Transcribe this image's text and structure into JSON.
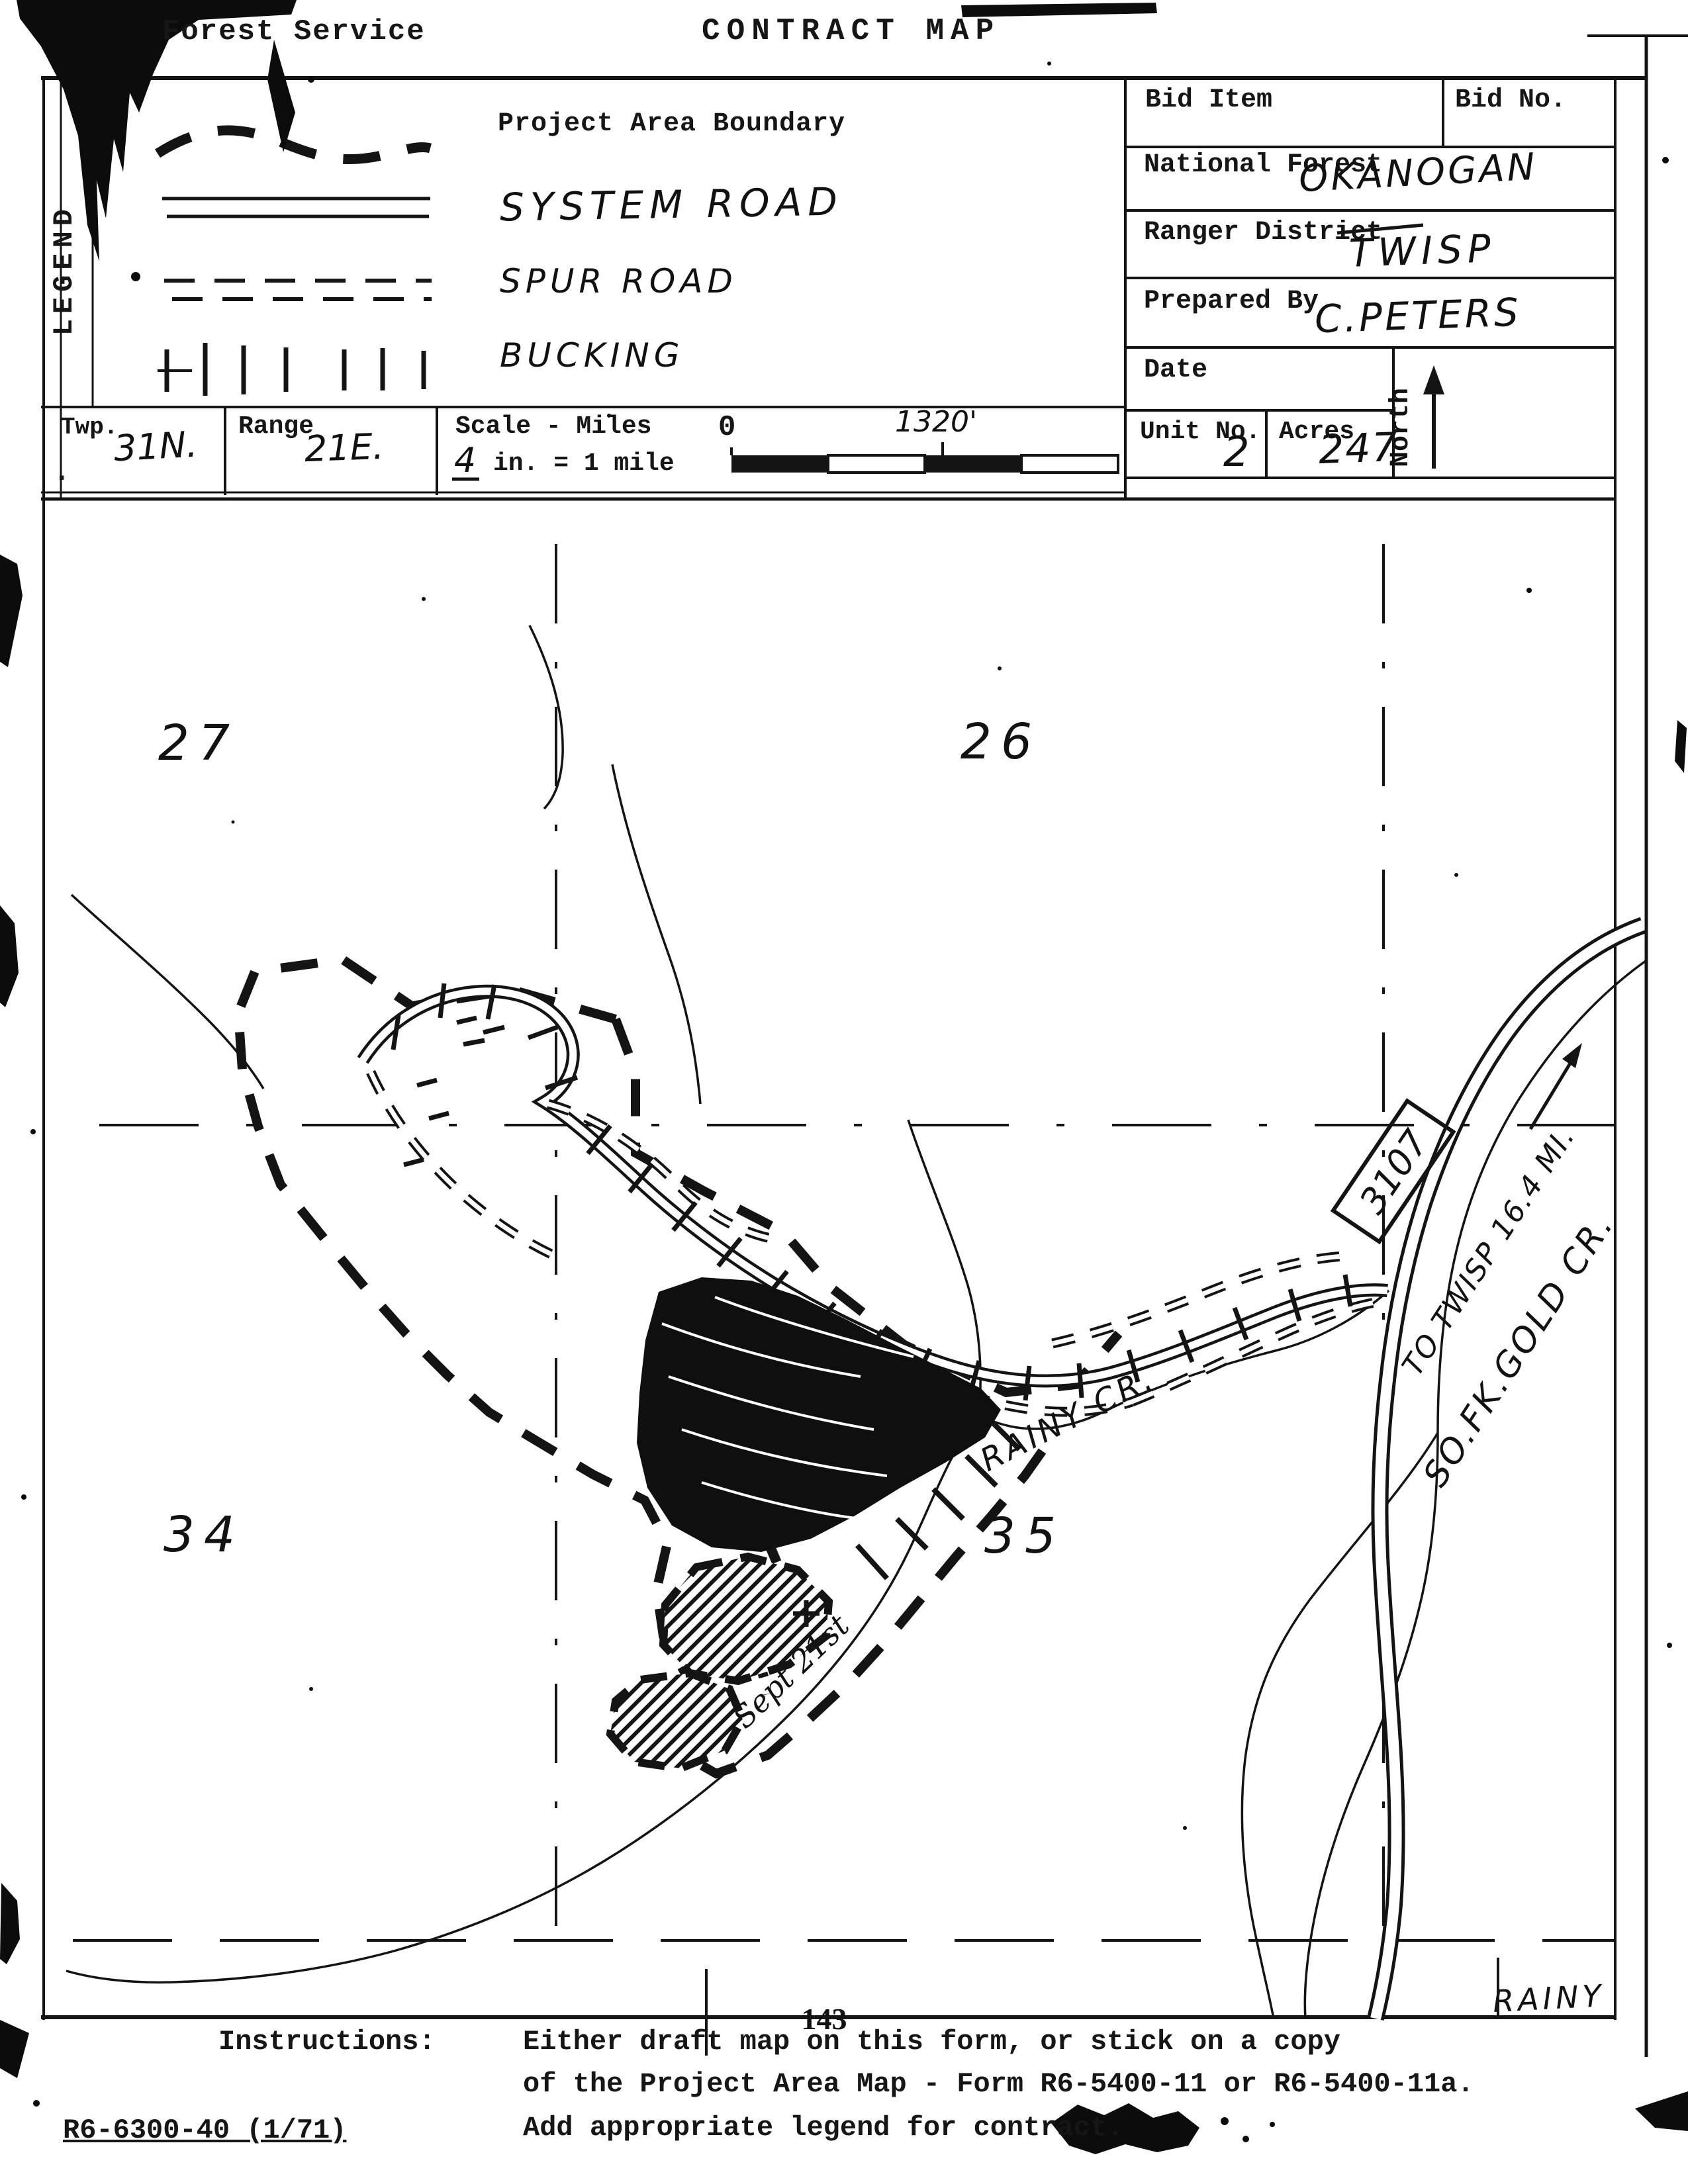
{
  "header": {
    "agency": "Forest Service",
    "title": "CONTRACT MAP",
    "bid_item_label": "Bid Item",
    "bid_no_label": "Bid No.",
    "national_forest_label": "National Forest",
    "national_forest_value": "OKANOGAN",
    "ranger_district_label": "Ranger District",
    "ranger_district_value": "TWISP",
    "prepared_by_label": "Prepared By",
    "prepared_by_value": "C.PETERS",
    "date_label": "Date",
    "north_label": "North",
    "unit_no_label": "Unit No.",
    "unit_no_value": "2",
    "acres_label": "Acres",
    "acres_value": "247",
    "twp_label": "Twp.",
    "twp_value": "31N.",
    "range_label": "Range",
    "range_value": "21E.",
    "scale_label": "Scale - Miles",
    "scale_value_fraction": "4",
    "scale_value_rest": "in. = 1 mile",
    "scale_zero": "0",
    "scale_distance": "1320'"
  },
  "legend": {
    "title": "LEGEND",
    "items": [
      {
        "symbol": "project-area-boundary-line",
        "label": "Project Area Boundary"
      },
      {
        "symbol": "system-road-line",
        "label": "SYSTEM ROAD"
      },
      {
        "symbol": "spur-road-line",
        "label": "SPUR ROAD"
      },
      {
        "symbol": "bucking-ticks",
        "label": "BUCKING"
      }
    ]
  },
  "map": {
    "section_numbers": [
      "27",
      "26",
      "34",
      "35"
    ],
    "road_number": "3107",
    "to_twisp_note": "TO TWISP 16.4 MI.",
    "gold_creek_label": "SO.FK.GOLD CR.",
    "rainy_creek_label": "RAINY CR.",
    "rainy_corner_label": "RAINY",
    "date_note": "Sept 21st"
  },
  "footer": {
    "page_number": "143",
    "instructions_label": "Instructions:",
    "instructions_lines": [
      "Either draft map on this form, or stick on a copy",
      "of the Project Area Map - Form R6-5400-11 or R6-5400-11a.",
      "Add appropriate legend for contract."
    ],
    "form_number": "R6-6300-40 (1/71)"
  }
}
